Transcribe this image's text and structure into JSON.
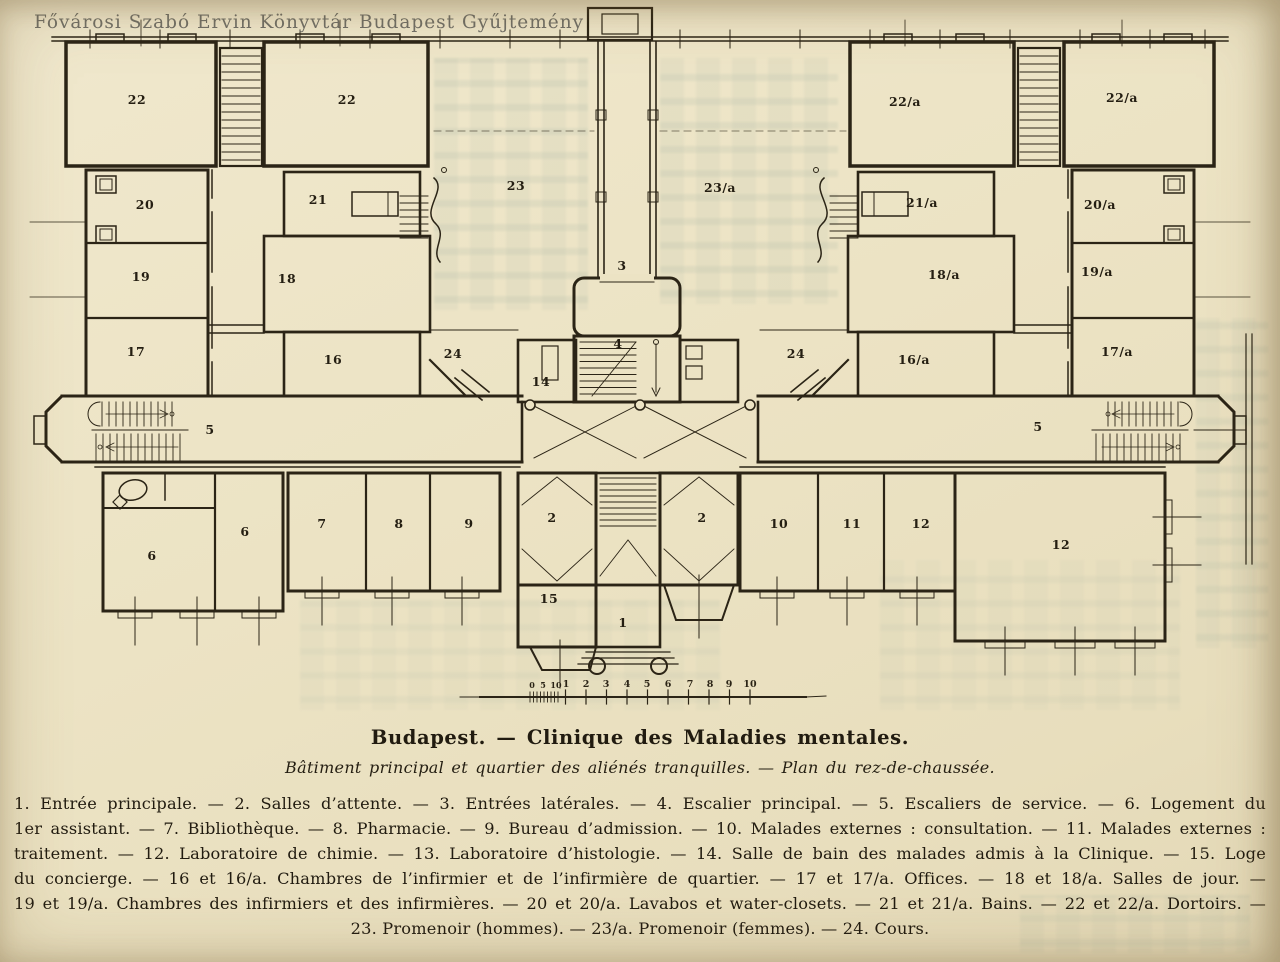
{
  "page": {
    "watermark": "Fővárosi Szabó Ervin Könyvtár Budapest Gyűjtemény",
    "paper_color": "#ece3c4",
    "ink_color": "#2b2416",
    "watermark_color": "#60605a",
    "bleed_color": "#79968d"
  },
  "caption": {
    "title": "Budapest. — Clinique des Maladies mentales.",
    "subtitle": "Bâtiment principal et quartier des aliénés tranquilles. — Plan du rez-de-chaussée.",
    "legend_lines": [
      "1. Entrée principale. — 2. Salles d’attente. — 3. Entrées latérales. — 4. Escalier principal. — 5. Escaliers de service. — 6. Logement du",
      "1er assistant. — 7. Bibliothèque. — 8. Pharmacie. — 9. Bureau d’admission. — 10. Malades externes : consultation. — 11. Malades externes :",
      "traitement. — 12. Laboratoire de chimie. — 13. Laboratoire d’histologie. — 14. Salle de bain des malades admis à la Clinique. — 15. Loge",
      "du concierge. — 16 et 16/a. Chambres de l’infirmier et de l’infirmière de quartier. — 17 et 17/a. Offices. — 18 et 18/a. Salles de jour. —",
      "19 et 19/a. Chambres des infirmiers et des infirmières. — 20 et 20/a. Lavabos et water-closets. — 21 et 21/a. Bains. — 22 et 22/a. Dortoirs. —",
      "23. Promenoir (hommes). — 23/a. Promenoir (femmes). — 24. Cours."
    ]
  },
  "plan": {
    "room_labels": [
      {
        "label": "22",
        "x": 137,
        "y": 104
      },
      {
        "label": "22",
        "x": 347,
        "y": 104
      },
      {
        "label": "22/a",
        "x": 905,
        "y": 106
      },
      {
        "label": "22/a",
        "x": 1122,
        "y": 102
      },
      {
        "label": "20",
        "x": 145,
        "y": 209
      },
      {
        "label": "21",
        "x": 318,
        "y": 204
      },
      {
        "label": "21/a",
        "x": 922,
        "y": 207
      },
      {
        "label": "20/a",
        "x": 1100,
        "y": 209
      },
      {
        "label": "19",
        "x": 141,
        "y": 281
      },
      {
        "label": "18",
        "x": 287,
        "y": 283
      },
      {
        "label": "18/a",
        "x": 944,
        "y": 279
      },
      {
        "label": "19/a",
        "x": 1097,
        "y": 276
      },
      {
        "label": "17",
        "x": 136,
        "y": 356
      },
      {
        "label": "16",
        "x": 333,
        "y": 364
      },
      {
        "label": "16/a",
        "x": 914,
        "y": 364
      },
      {
        "label": "17/a",
        "x": 1117,
        "y": 356
      },
      {
        "label": "23",
        "x": 516,
        "y": 190
      },
      {
        "label": "23/a",
        "x": 720,
        "y": 192
      },
      {
        "label": "3",
        "x": 622,
        "y": 270
      },
      {
        "label": "4",
        "x": 618,
        "y": 348
      },
      {
        "label": "14",
        "x": 541,
        "y": 386
      },
      {
        "label": "24",
        "x": 453,
        "y": 358
      },
      {
        "label": "24",
        "x": 796,
        "y": 358
      },
      {
        "label": "5",
        "x": 210,
        "y": 434
      },
      {
        "label": "5",
        "x": 1038,
        "y": 431
      },
      {
        "label": "6",
        "x": 152,
        "y": 560
      },
      {
        "label": "6",
        "x": 245,
        "y": 536
      },
      {
        "label": "7",
        "x": 322,
        "y": 528
      },
      {
        "label": "8",
        "x": 399,
        "y": 528
      },
      {
        "label": "9",
        "x": 469,
        "y": 528
      },
      {
        "label": "2",
        "x": 552,
        "y": 522
      },
      {
        "label": "2",
        "x": 702,
        "y": 522
      },
      {
        "label": "10",
        "x": 779,
        "y": 528
      },
      {
        "label": "11",
        "x": 852,
        "y": 528
      },
      {
        "label": "12",
        "x": 921,
        "y": 528
      },
      {
        "label": "12",
        "x": 1061,
        "y": 549
      },
      {
        "label": "15",
        "x": 549,
        "y": 603
      },
      {
        "label": "1",
        "x": 623,
        "y": 627
      }
    ],
    "scale_bar": {
      "minor_labels": [
        {
          "t": "0",
          "x": 532
        },
        {
          "t": "5",
          "x": 543
        },
        {
          "t": "10",
          "x": 556
        }
      ],
      "major_labels": [
        {
          "t": "1",
          "x": 566
        },
        {
          "t": "2",
          "x": 586
        },
        {
          "t": "3",
          "x": 606
        },
        {
          "t": "4",
          "x": 627
        },
        {
          "t": "5",
          "x": 647
        },
        {
          "t": "6",
          "x": 668
        },
        {
          "t": "7",
          "x": 690
        },
        {
          "t": "8",
          "x": 710
        },
        {
          "t": "9",
          "x": 729
        },
        {
          "t": "10",
          "x": 750
        }
      ]
    }
  }
}
